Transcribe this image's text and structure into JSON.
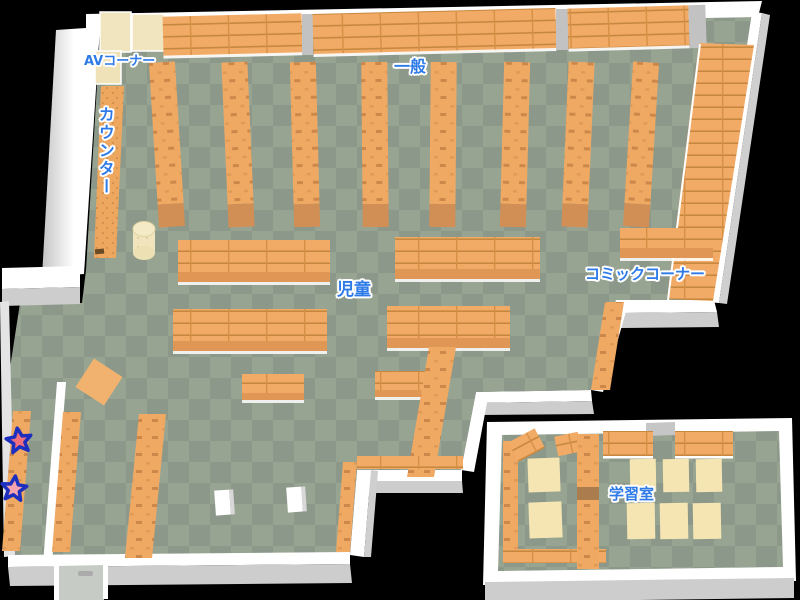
{
  "map": {
    "labels": {
      "av_corner": "AVコーナー",
      "general": "一般",
      "counter": "カウンター",
      "children": "児童",
      "comic_corner": "コミックコーナー",
      "study_room": "学習室"
    },
    "markers": [
      {
        "id": "star-1",
        "shape": "star",
        "fill": "#EF6F7D",
        "outline": "#1D2FBE"
      },
      {
        "id": "star-2",
        "shape": "star",
        "fill": "#F5A3AE",
        "outline": "#1D2FBE"
      }
    ],
    "colors": {
      "background": "#000000",
      "floor_light": "#98A492",
      "floor_dark": "#8B988A",
      "wall": "#FFFFFF",
      "wall_shadow": "#CDCDCD",
      "shelf": "#F0A963",
      "shelf_line": "#C6873E",
      "shelf_front": "#E09756",
      "shelf_end": "#D18F55",
      "cream": "#F1E5C0",
      "table": "#F5E5B3",
      "label_text": "#2E7BE8",
      "label_outline": "#FFFFFF"
    }
  }
}
